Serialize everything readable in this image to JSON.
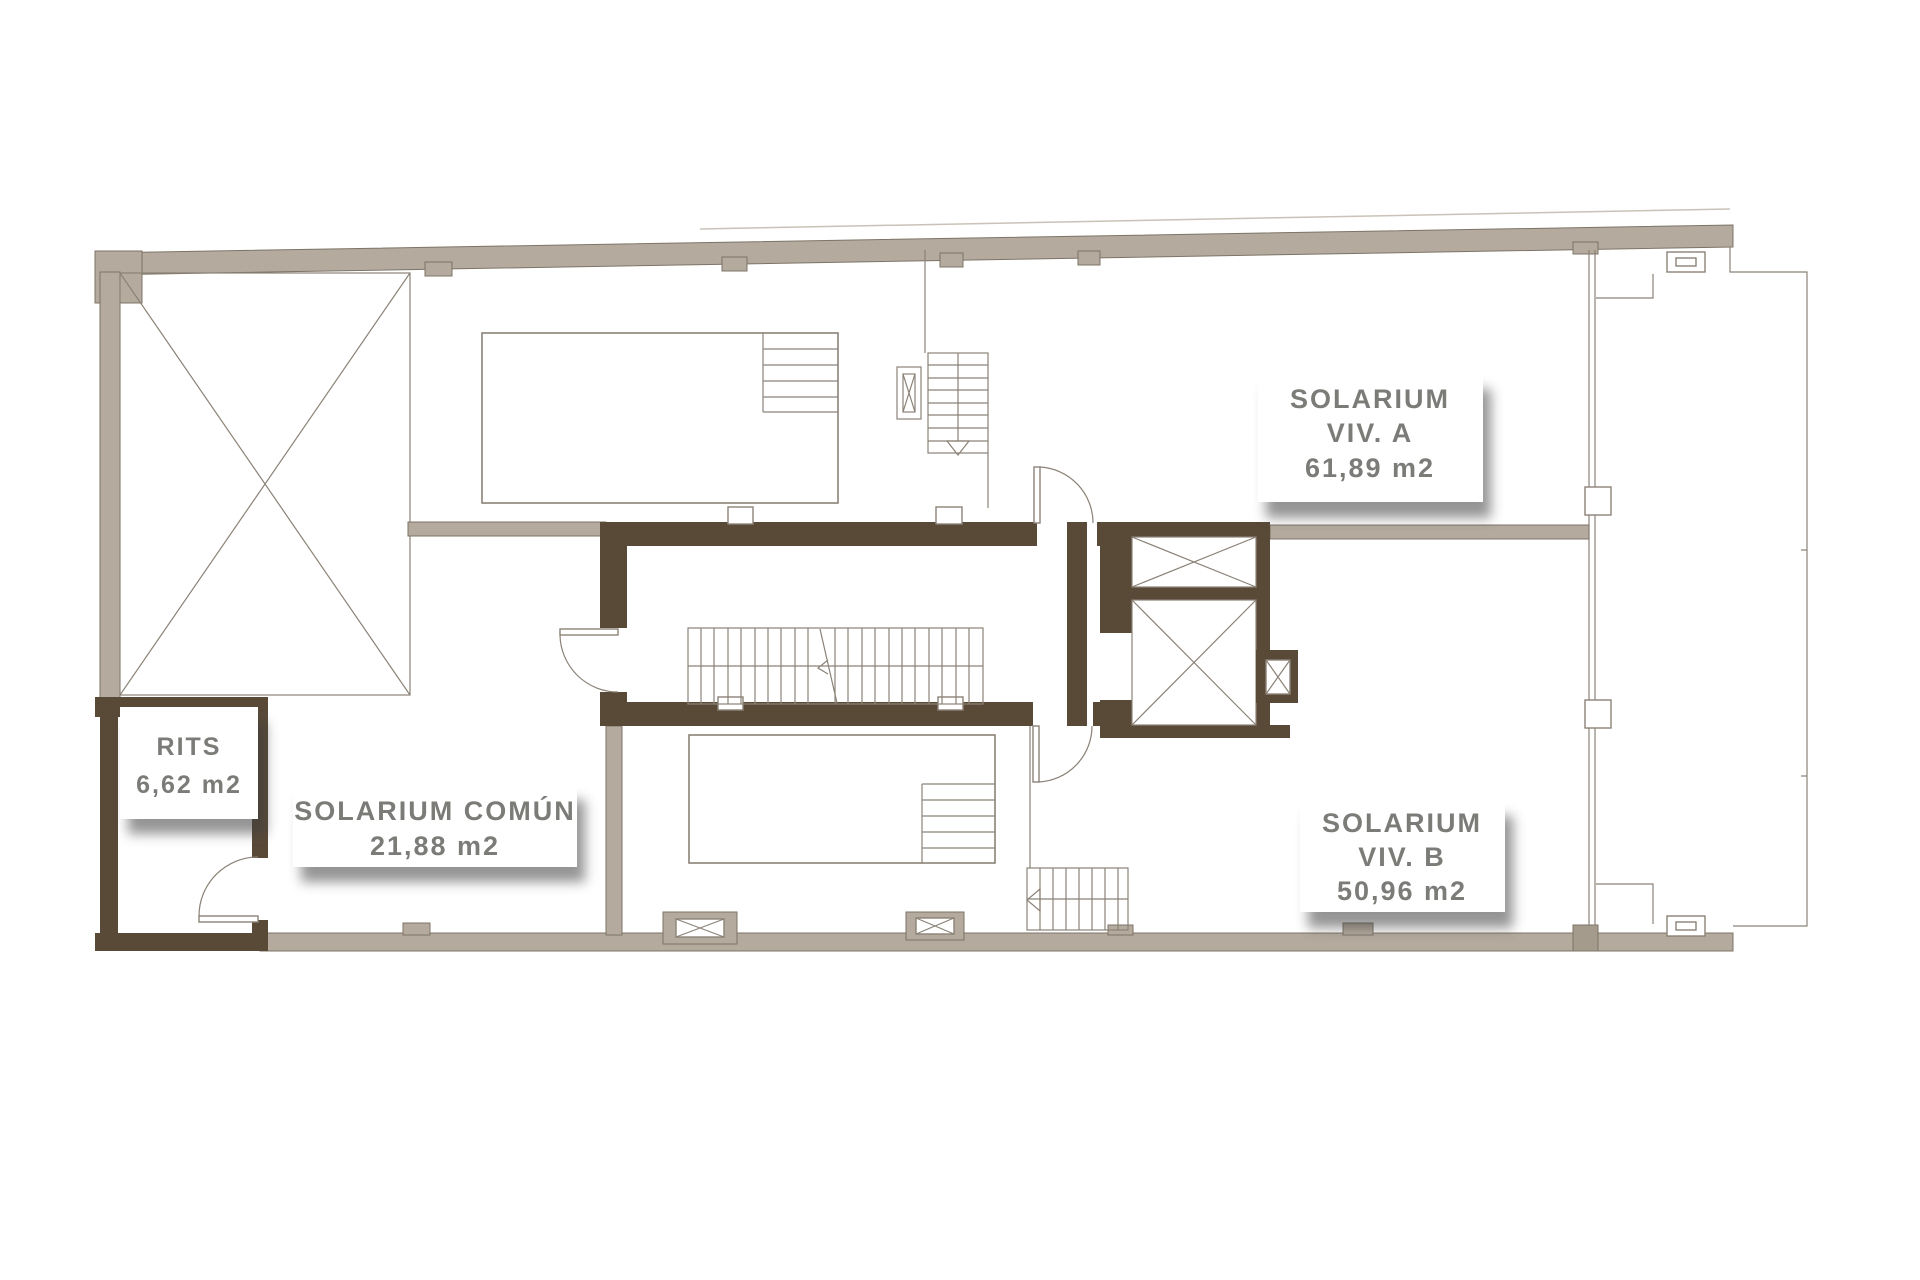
{
  "plan": {
    "kind": "architectural-floor-plan",
    "labels": {
      "solarium_a": {
        "title": "SOLARIUM",
        "subtitle": "VIV. A",
        "area": "61,89 m2"
      },
      "solarium_b": {
        "title": "SOLARIUM",
        "subtitle": "VIV. B",
        "area": "50,96 m2"
      },
      "solarium_comun": {
        "title": "SOLARIUM COMÚN",
        "area": "21,88 m2"
      },
      "rits": {
        "title": "RITS",
        "area": "6,62 m2"
      }
    },
    "colors": {
      "exterior_wall": "#b4aa9e",
      "exterior_wall_dark": "#a59b8d",
      "interior_wall": "#594a38",
      "line": "#8b8277",
      "label_text": "#7b7b78",
      "label_shadow": "#3c3c3c",
      "background": "#ffffff"
    },
    "symbols": [
      "skylight-cross-icon",
      "elevator-shaft-cross-icon",
      "stair-run-icon",
      "pool-steps-icon",
      "door-swing-icon",
      "vent-cross-icon"
    ]
  }
}
